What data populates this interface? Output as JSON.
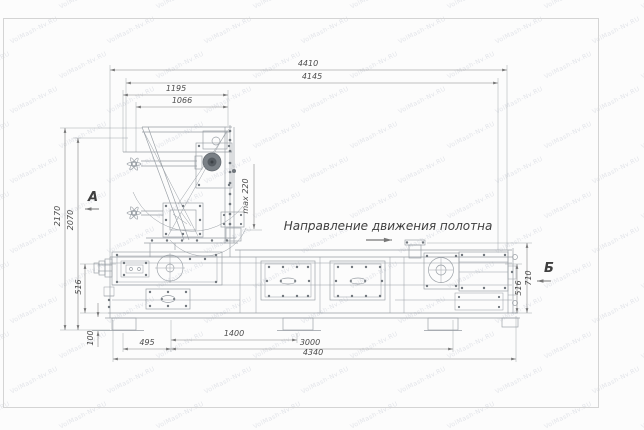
{
  "page": {
    "background": "#fcfcfc",
    "frame_color": "#d4d4d4"
  },
  "watermark": {
    "text": "VolMash-Nv.RU",
    "color": "rgba(100,115,145,0.17)"
  },
  "drawing": {
    "direction_label": "Направление движения полотна",
    "view_label_a": "А",
    "view_label_b": "Б",
    "max_height_label": "max 220",
    "colors": {
      "machine_line": "#979da3",
      "dimension_line": "#858585",
      "text": "#4b4b4b"
    }
  },
  "dimensions": {
    "top": [
      "4410",
      "4145",
      "1195",
      "1066"
    ],
    "left": [
      "2170",
      "2070",
      "516",
      "100"
    ],
    "right": [
      "710",
      "516"
    ],
    "bottom": [
      "1400",
      "495",
      "3000",
      "4340"
    ]
  }
}
